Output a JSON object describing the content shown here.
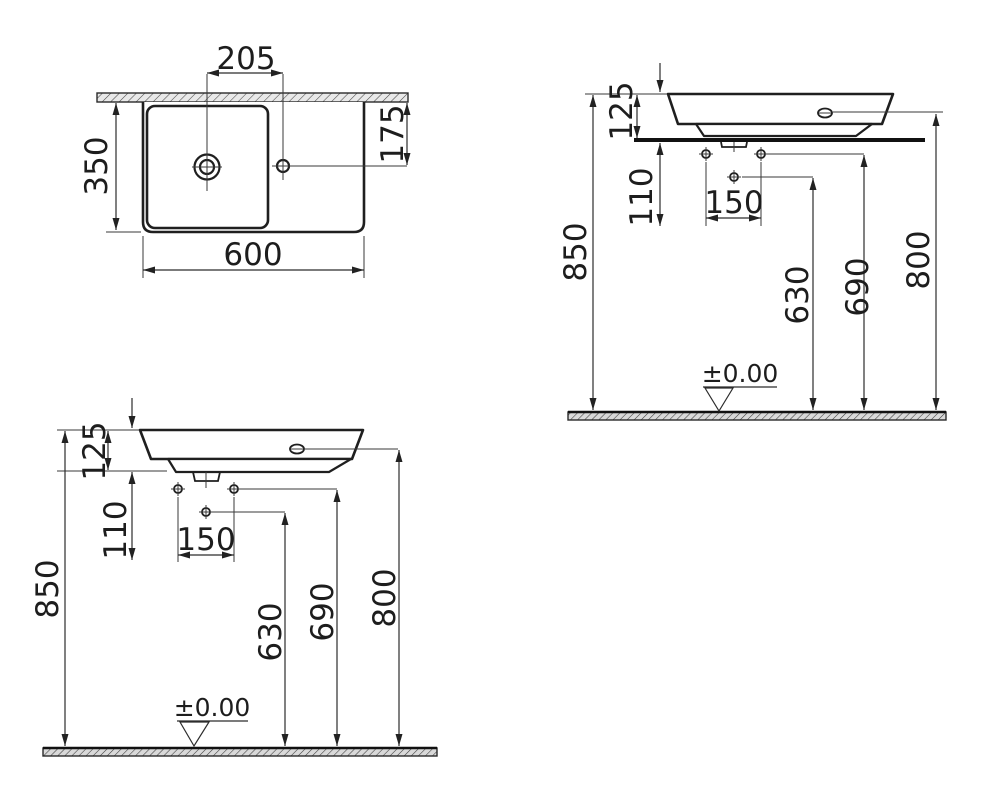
{
  "colors": {
    "line": "#222222",
    "background": "#ffffff",
    "text": "#1d1d1d"
  },
  "plan_view": {
    "dim_tap_to_hole": "205",
    "dim_hole_from_wall": "175",
    "dim_depth": "350",
    "dim_width": "600"
  },
  "front_view": {
    "dim_basin_thickness": "125",
    "dim_hole_offset": "110",
    "dim_hole_spacing": "150",
    "dim_rim_height": "850",
    "dim_mid_hole_height": "630",
    "dim_side_hole_height": "690",
    "dim_overflow_height": "800",
    "floor_datum": "±0.00"
  },
  "side_view": {
    "dim_basin_thickness": "125",
    "dim_hole_offset": "110",
    "dim_hole_spacing": "150",
    "dim_rim_height": "850",
    "dim_mid_hole_height": "630",
    "dim_side_hole_height": "690",
    "dim_overflow_height": "800",
    "floor_datum": "±0.00"
  }
}
